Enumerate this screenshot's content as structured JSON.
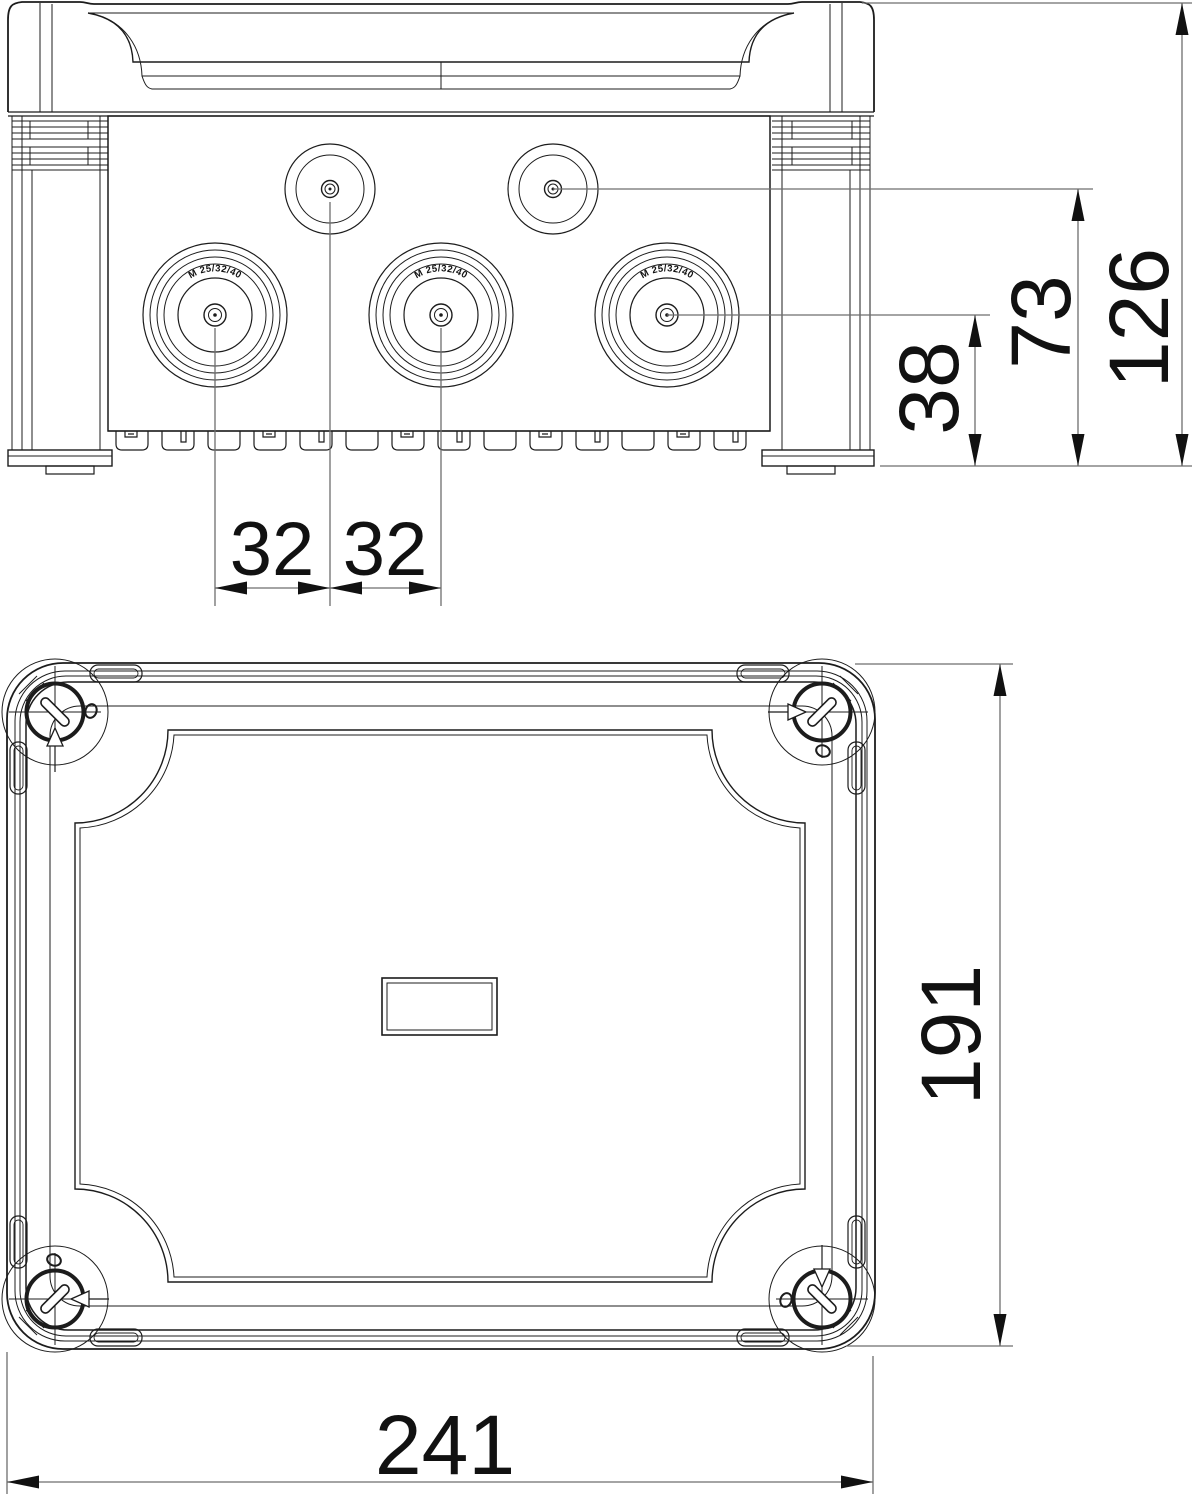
{
  "drawing": {
    "colors": {
      "line": "#1c1c1c",
      "dimension_line": "#6e6e6e",
      "text": "#111111",
      "background": "#ffffff"
    },
    "side_view": {
      "knockout_label": "M 25/32/40",
      "dims": {
        "overall_height": "126",
        "upper_entry_height": "73",
        "lower_entry_height": "38",
        "entry_spacing_left": "32",
        "entry_spacing_right": "32"
      }
    },
    "lid_view": {
      "dims": {
        "height": "191",
        "width": "241"
      }
    }
  }
}
